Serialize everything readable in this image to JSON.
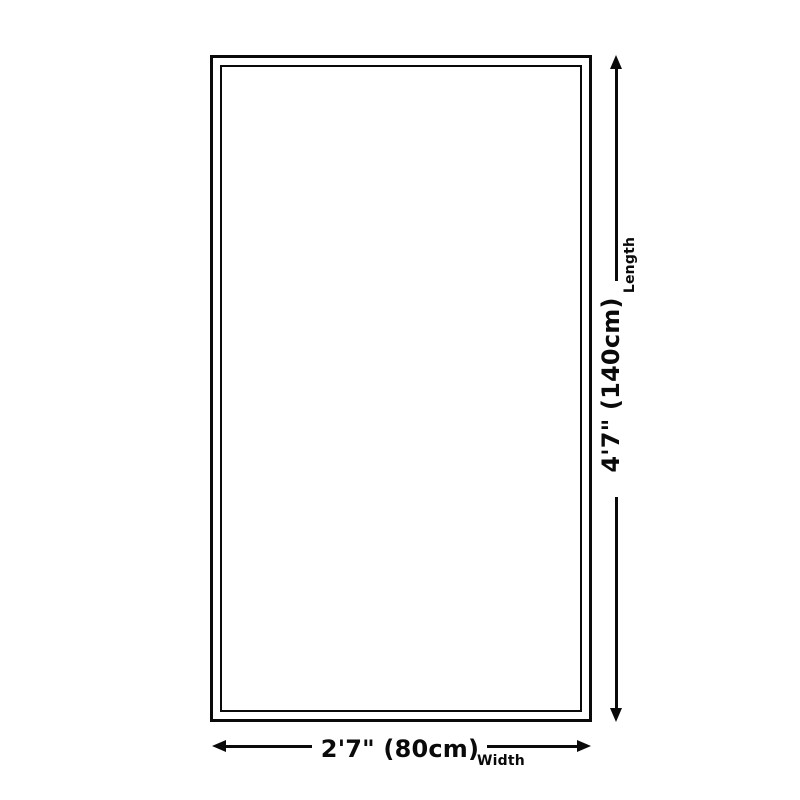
{
  "diagram": {
    "length": {
      "value": "4'7\" (140cm)",
      "label": "Length"
    },
    "width": {
      "value": "2'7\" (80cm)",
      "label": "Width"
    },
    "colors": {
      "line": "#0a0a0a",
      "background": "#ffffff"
    }
  }
}
